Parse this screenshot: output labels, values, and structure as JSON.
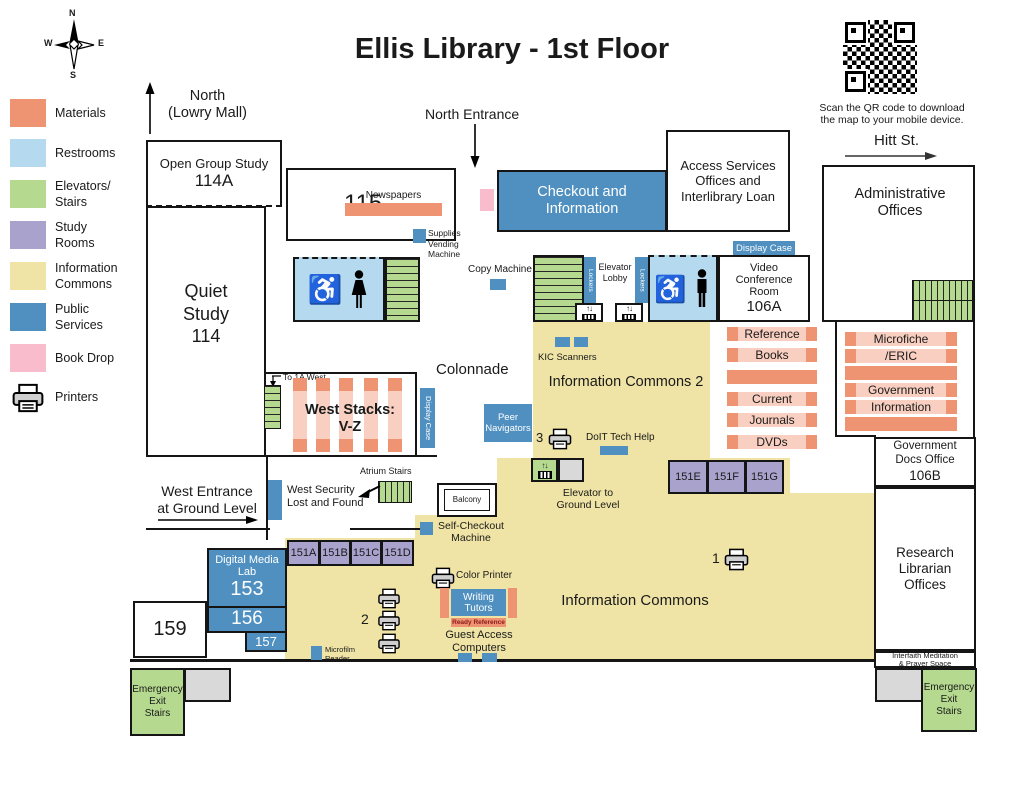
{
  "title": "Ellis Library - 1st Floor",
  "compass": {
    "n": "N",
    "e": "E",
    "s": "S",
    "w": "W"
  },
  "qr": {
    "caption": "Scan the QR code to download\nthe map to your mobile device."
  },
  "streets": {
    "hitt": "Hitt St."
  },
  "legend": {
    "items": [
      {
        "name": "materials",
        "label": "Materials",
        "color": "#EF9472"
      },
      {
        "name": "restrooms",
        "label": "Restrooms",
        "color": "#B5D9EF"
      },
      {
        "name": "elevators-stairs",
        "label": "Elevators/\nStairs",
        "color": "#B5D98F"
      },
      {
        "name": "study-rooms",
        "label": "Study\nRooms",
        "color": "#A8A2CC"
      },
      {
        "name": "information-commons",
        "label": "Information\nCommons",
        "color": "#EFE4A5"
      },
      {
        "name": "public-services",
        "label": "Public\nServices",
        "color": "#4F90C1"
      },
      {
        "name": "book-drop",
        "label": "Book Drop",
        "color": "#F8BCCD"
      },
      {
        "name": "printers",
        "label": "Printers"
      }
    ]
  },
  "entrances": {
    "north": "North\n(Lowry Mall)",
    "north_entrance": "North Entrance",
    "west_entrance": "West Entrance\nat Ground Level"
  },
  "rooms": {
    "open_group_study": "Open Group Study",
    "open_group_study_num": "114A",
    "room_115": "115",
    "checkout": "Checkout and\nInformation",
    "access_services": "Access Services\nOffices and\nInterlibrary Loan",
    "admin_offices": "Administrative\nOffices",
    "video_conference": "Video\nConference\nRoom",
    "video_conference_num": "106A",
    "quiet_study": "Quiet\nStudy\n114",
    "info_commons_2": "Information Commons 2",
    "info_commons": "Information Commons",
    "colonnade": "Colonnade",
    "west_stacks": "West Stacks:\nV-Z",
    "gov_docs": "Government\nDocs Office",
    "gov_docs_num": "106B",
    "research_librarian": "Research\nLibrarian\nOffices",
    "digital_media_lab": "Digital Media\nLab",
    "room_153": "153",
    "room_156": "156",
    "room_157": "157",
    "room_159": "159",
    "interfaith": "Interfaith Meditation\n& Prayer Space",
    "emergency_exit": "Emergency\nExit\nStairs",
    "study_rooms_west": [
      "151A",
      "151B",
      "151C",
      "151D"
    ],
    "study_rooms_east": [
      "151E",
      "151F",
      "151G"
    ]
  },
  "features": {
    "newspapers": "Newspapers",
    "supplies_vending": "Supplies\nVending\nMachine",
    "display_case": "Display Case",
    "copy_machine": "Copy Machine",
    "lockers": "Lockers",
    "elevator_lobby": "Elevator\nLobby",
    "kic_scanners": "KIC Scanners",
    "doit_tech_help": "DoIT Tech Help",
    "peer_navigators": "Peer\nNavigators",
    "to_1a_west": "To 1A West",
    "atrium_stairs": "Atrium Stairs",
    "west_security": "West Security\nLost and Found",
    "balcony": "Balcony",
    "elevator_to_ground": "Elevator to\nGround Level",
    "self_checkout": "Self-Checkout\nMachine",
    "color_printer": "Color Printer",
    "writing_tutors": "Writing\nTutors",
    "ready_reference": "Ready Reference",
    "guest_access": "Guest Access\nComputers",
    "microfilm_reader": "Microfilm\nReader",
    "printer_1": "1",
    "printer_2": "2",
    "printer_3": "3"
  },
  "shelves": {
    "block_a": [
      "Reference",
      "Books",
      "",
      "Current",
      "Journals",
      "DVDs"
    ],
    "block_b": [
      "Microfiche",
      "/ERIC",
      "",
      "Government",
      "Information",
      ""
    ]
  }
}
